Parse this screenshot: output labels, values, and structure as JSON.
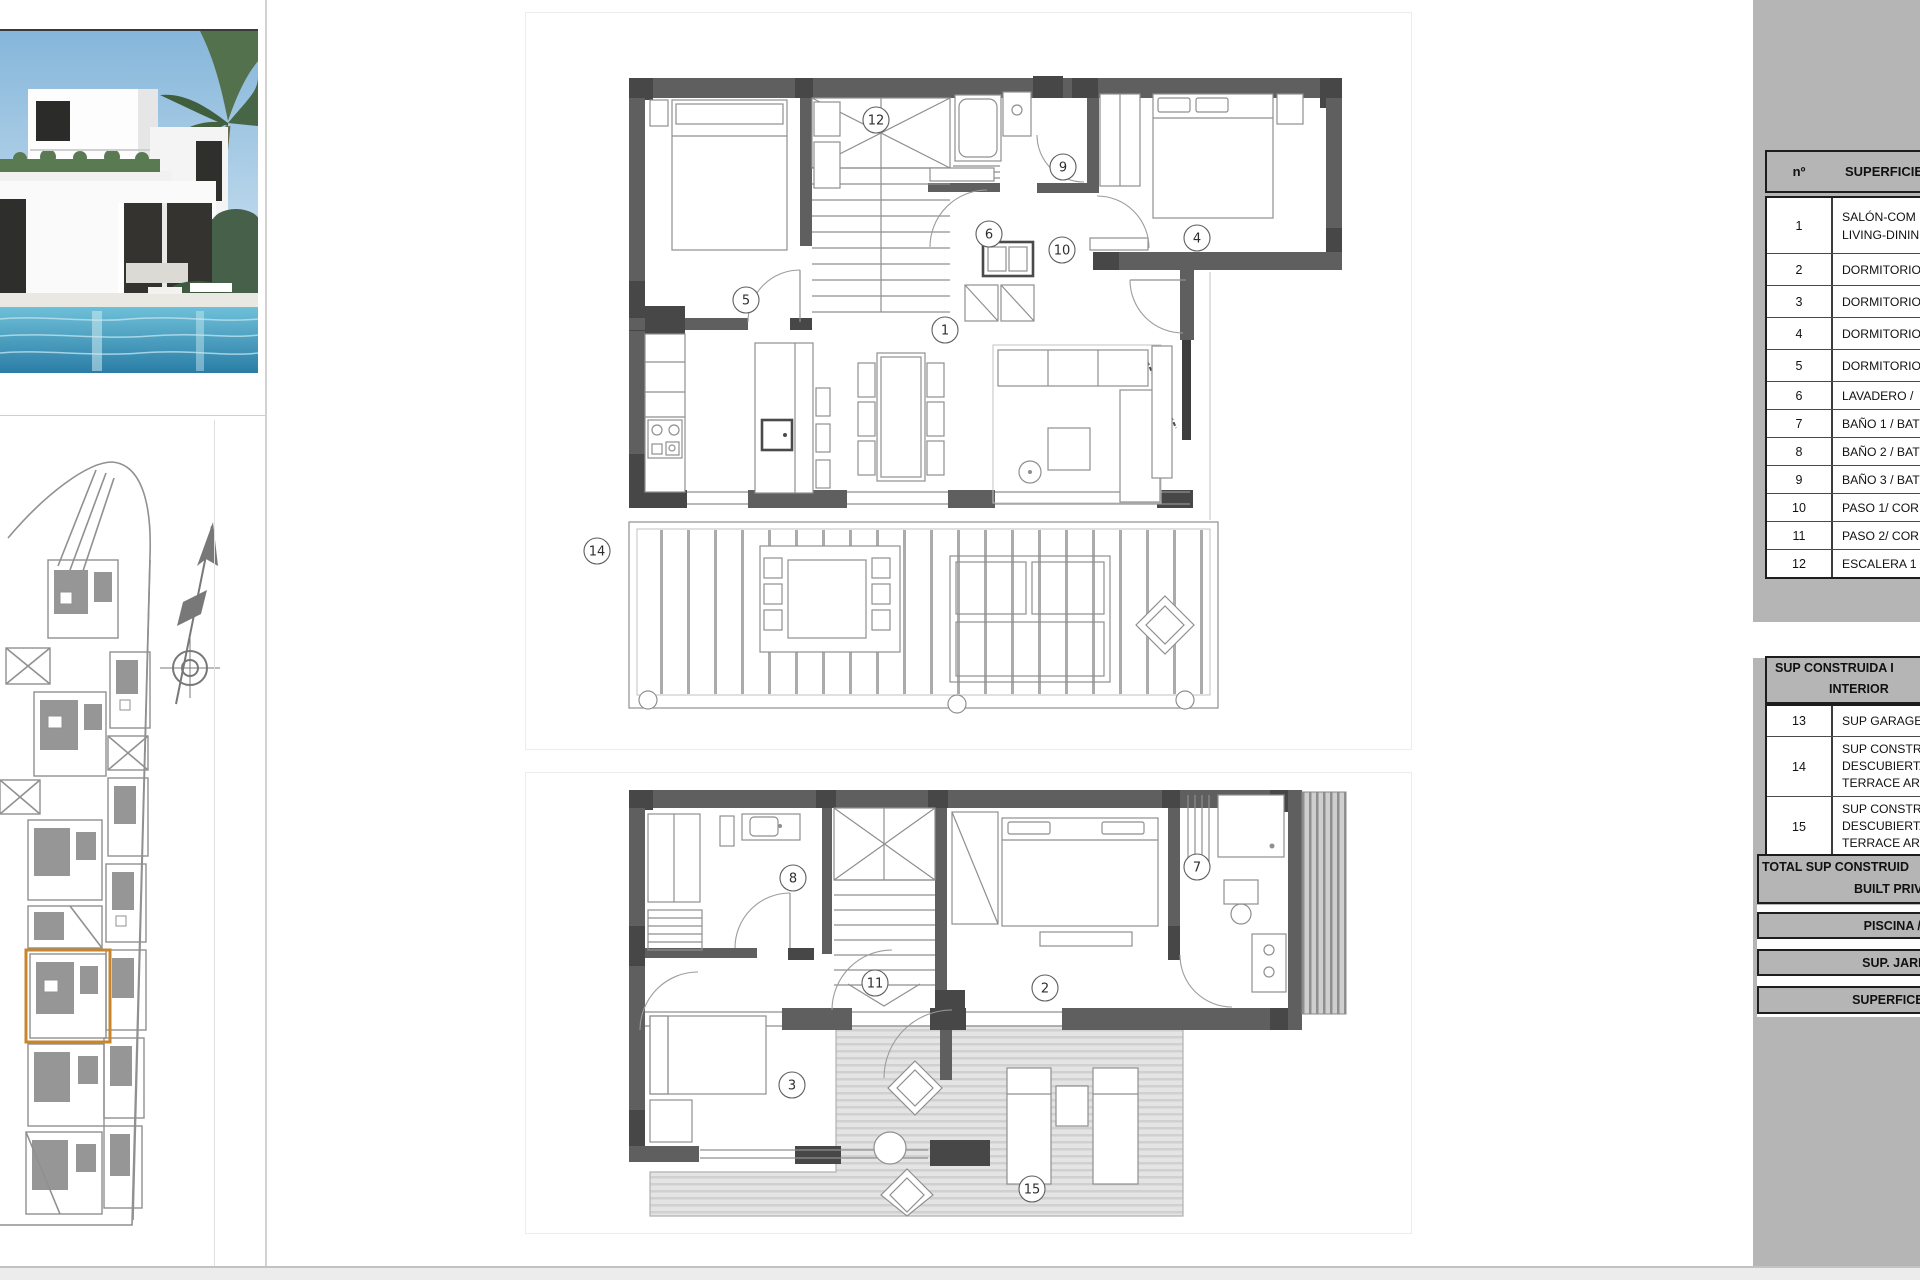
{
  "photo": {
    "description": "Modern white two-storey villa with swimming pool and palm trees"
  },
  "site_plan": {
    "description": "Urbanisation site plan with highlighted plot",
    "highlight_color": "#c8862c",
    "compass_icon": "north-arrow-icon"
  },
  "floor_plans": {
    "first_floor": {
      "room_labels": [
        "12",
        "9",
        "4",
        "6",
        "10",
        "5",
        "1",
        "14"
      ]
    },
    "ground_floor": {
      "room_labels": [
        "8",
        "7",
        "11",
        "2",
        "3",
        "15"
      ]
    }
  },
  "legend": {
    "header": {
      "num": "nº",
      "label": "SUPERFICIE Ú"
    },
    "rooms": [
      {
        "num": "1",
        "lines": [
          "SALÓN-COM",
          "LIVING-DININ"
        ]
      },
      {
        "num": "2",
        "lines": [
          "DORMITORIO"
        ]
      },
      {
        "num": "3",
        "lines": [
          "DORMITORIO"
        ]
      },
      {
        "num": "4",
        "lines": [
          "DORMITORIO"
        ]
      },
      {
        "num": "5",
        "lines": [
          "DORMITORIO"
        ]
      },
      {
        "num": "6",
        "lines": [
          "LAVADERO /"
        ]
      },
      {
        "num": "7",
        "lines": [
          "BAÑO 1 / BAT"
        ]
      },
      {
        "num": "8",
        "lines": [
          "BAÑO 2 / BAT"
        ]
      },
      {
        "num": "9",
        "lines": [
          "BAÑO 3 / BAT"
        ]
      },
      {
        "num": "10",
        "lines": [
          "PASO 1/ COR"
        ]
      },
      {
        "num": "11",
        "lines": [
          "PASO 2/ COR"
        ]
      },
      {
        "num": "12",
        "lines": [
          "ESCALERA 1 /"
        ]
      }
    ],
    "section2_header_lines": [
      "SUP CONSTRUIDA I",
      "INTERIOR"
    ],
    "built_rows": [
      {
        "num": "13",
        "lines": [
          "SUP GARAGE"
        ]
      },
      {
        "num": "14",
        "lines": [
          "SUP CONSTRU",
          "DESCUBIERTA",
          "TERRACE ARE"
        ]
      },
      {
        "num": "15",
        "lines": [
          "SUP CONSTRU",
          "DESCUBIERTA",
          "TERRACE ARE"
        ]
      }
    ],
    "total_lines": [
      "TOTAL SUP CONSTRUID",
      "BUILT PRIVA"
    ],
    "footer_rows": [
      "PISCINA / SWIM",
      "SUP. JARDÍN / G",
      "SUPERFICE PARCE"
    ]
  },
  "colors": {
    "sidebar": "#b5b5b5",
    "wall": "#5f5f5f",
    "wall_dark": "#474747",
    "accent_orange": "#c8862c",
    "terrace_hatch": "#e4e4e4"
  }
}
